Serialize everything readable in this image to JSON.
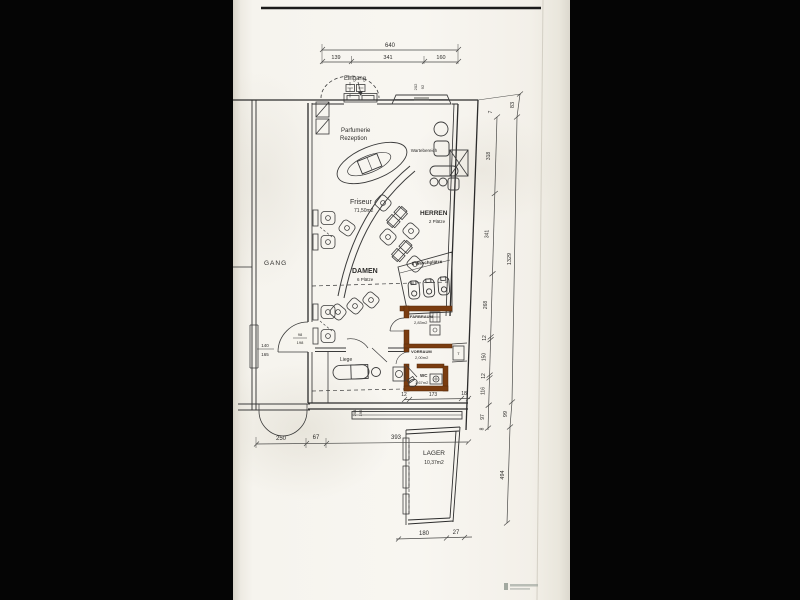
{
  "plan": {
    "labels": {
      "eingang": "Eingang",
      "gang": "GANG",
      "parfumerie": "Parfumerie",
      "rezeption": "Rezeption",
      "wartebereich": "Wartebereich",
      "friseur": "Friseur",
      "friseur_area": "71,50m2",
      "herren": "HERREN",
      "herren_seats": "2 Plätze",
      "damen": "DAMEN",
      "damen_seats": "6 Plätze",
      "waschplaetze": "3 Waschplätze",
      "farbraum": "FARBRAUM",
      "farbraum_area": "2,83m2",
      "vorraum": "VORRAUM",
      "vorraum_area": "2,00m2",
      "wc": "WC",
      "wc_area": "1,67m2",
      "liege": "Liege",
      "lager": "LAGER",
      "lager_area": "10,37m2",
      "boiler": "T"
    },
    "dims": {
      "top_total": "640",
      "top_segments": [
        "139",
        "341",
        "160"
      ],
      "right_outer": [
        "83",
        "1329",
        "99",
        "494"
      ],
      "right_chain": [
        "7",
        "318",
        "341",
        "268",
        "12",
        "150",
        "12",
        "116",
        "97",
        "8"
      ],
      "bottom_room": [
        "12",
        "173",
        "18"
      ],
      "bottom_main": [
        "250",
        "67",
        "393"
      ],
      "bottom_lager": [
        "180",
        "27"
      ],
      "gang_door": [
        "98",
        "198"
      ],
      "gang_window": [
        "140",
        "165"
      ],
      "top_window": [
        "202",
        "92"
      ],
      "bottom_window": [
        "204",
        "195"
      ]
    },
    "colors": {
      "new_wall": "#7a3c10",
      "new_wall_edge": "#52280a",
      "ink": "#333333"
    }
  }
}
